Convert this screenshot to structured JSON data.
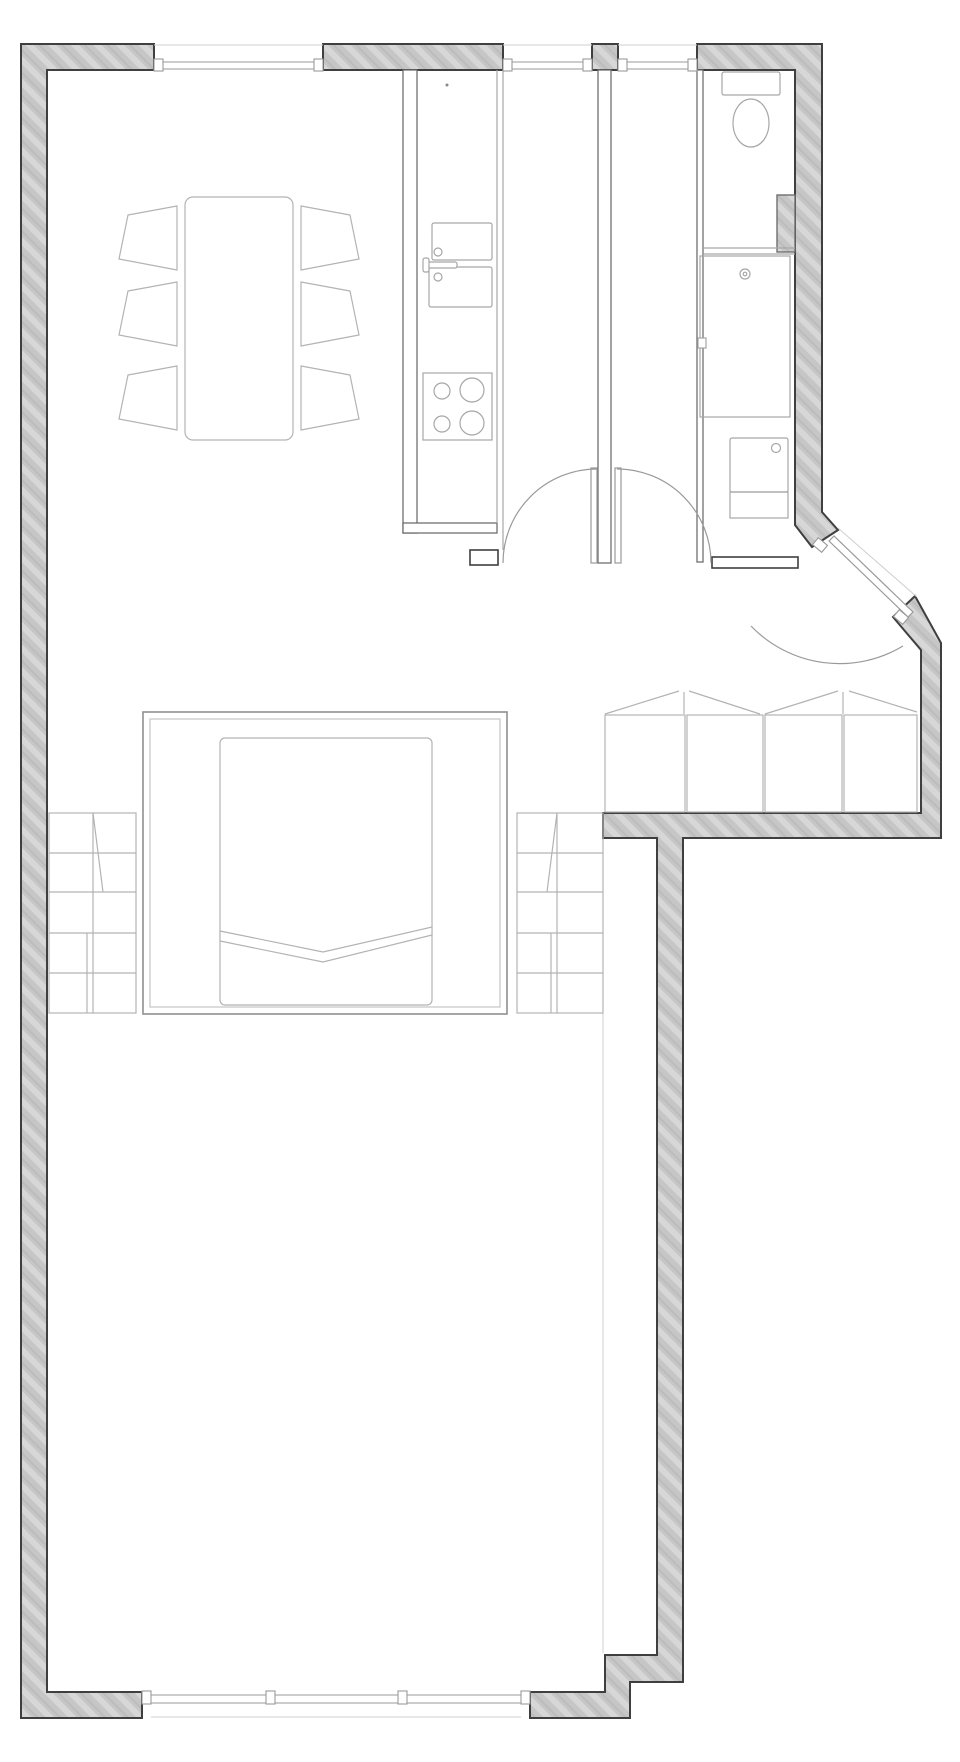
{
  "document": {
    "kind": "architectural-floor-plan",
    "visible_text": ""
  },
  "canvas": {
    "width": 960,
    "height": 1762,
    "background": "#ffffff"
  },
  "colors": {
    "paper": "#ffffff",
    "wall-fill": "#c6c6c6",
    "wall-hatch": "#d7d7d7",
    "wall-hatch2": "#bcbcbc",
    "wall-outline": "#3f3f3f",
    "partition-outline": "#6f6f6f",
    "furniture-stroke": "#b3b3b3",
    "fixture-stroke": "#a6a6a6",
    "glass-stroke": "#9a9a9a",
    "door-stroke": "#9a9a9a",
    "faint-line": "#cfcfcf"
  },
  "objects": [
    {
      "name": "exterior-walls",
      "style": "hatched"
    },
    {
      "name": "window",
      "count": 4,
      "locations": [
        "top-left",
        "top-middle",
        "top-right",
        "bottom-left"
      ]
    },
    {
      "name": "dining-table",
      "count": 1
    },
    {
      "name": "dining-chair",
      "count": 6
    },
    {
      "name": "kitchen-counter",
      "count": 1
    },
    {
      "name": "kitchen-sink",
      "basins": 2,
      "faucet-knobs": 2
    },
    {
      "name": "cooktop",
      "burners": 4
    },
    {
      "name": "toilet",
      "count": 1
    },
    {
      "name": "shower",
      "count": 1,
      "drain": true
    },
    {
      "name": "washing-machine",
      "count": 1
    },
    {
      "name": "double-bed",
      "count": 1,
      "blanket-fold": true
    },
    {
      "name": "wardrobe",
      "count": 2
    },
    {
      "name": "balcony-bench",
      "sections": 4,
      "cushions": 2
    },
    {
      "name": "swing-door",
      "count": 2
    },
    {
      "name": "entry-door",
      "count": 1,
      "orientation": "diagonal"
    }
  ]
}
